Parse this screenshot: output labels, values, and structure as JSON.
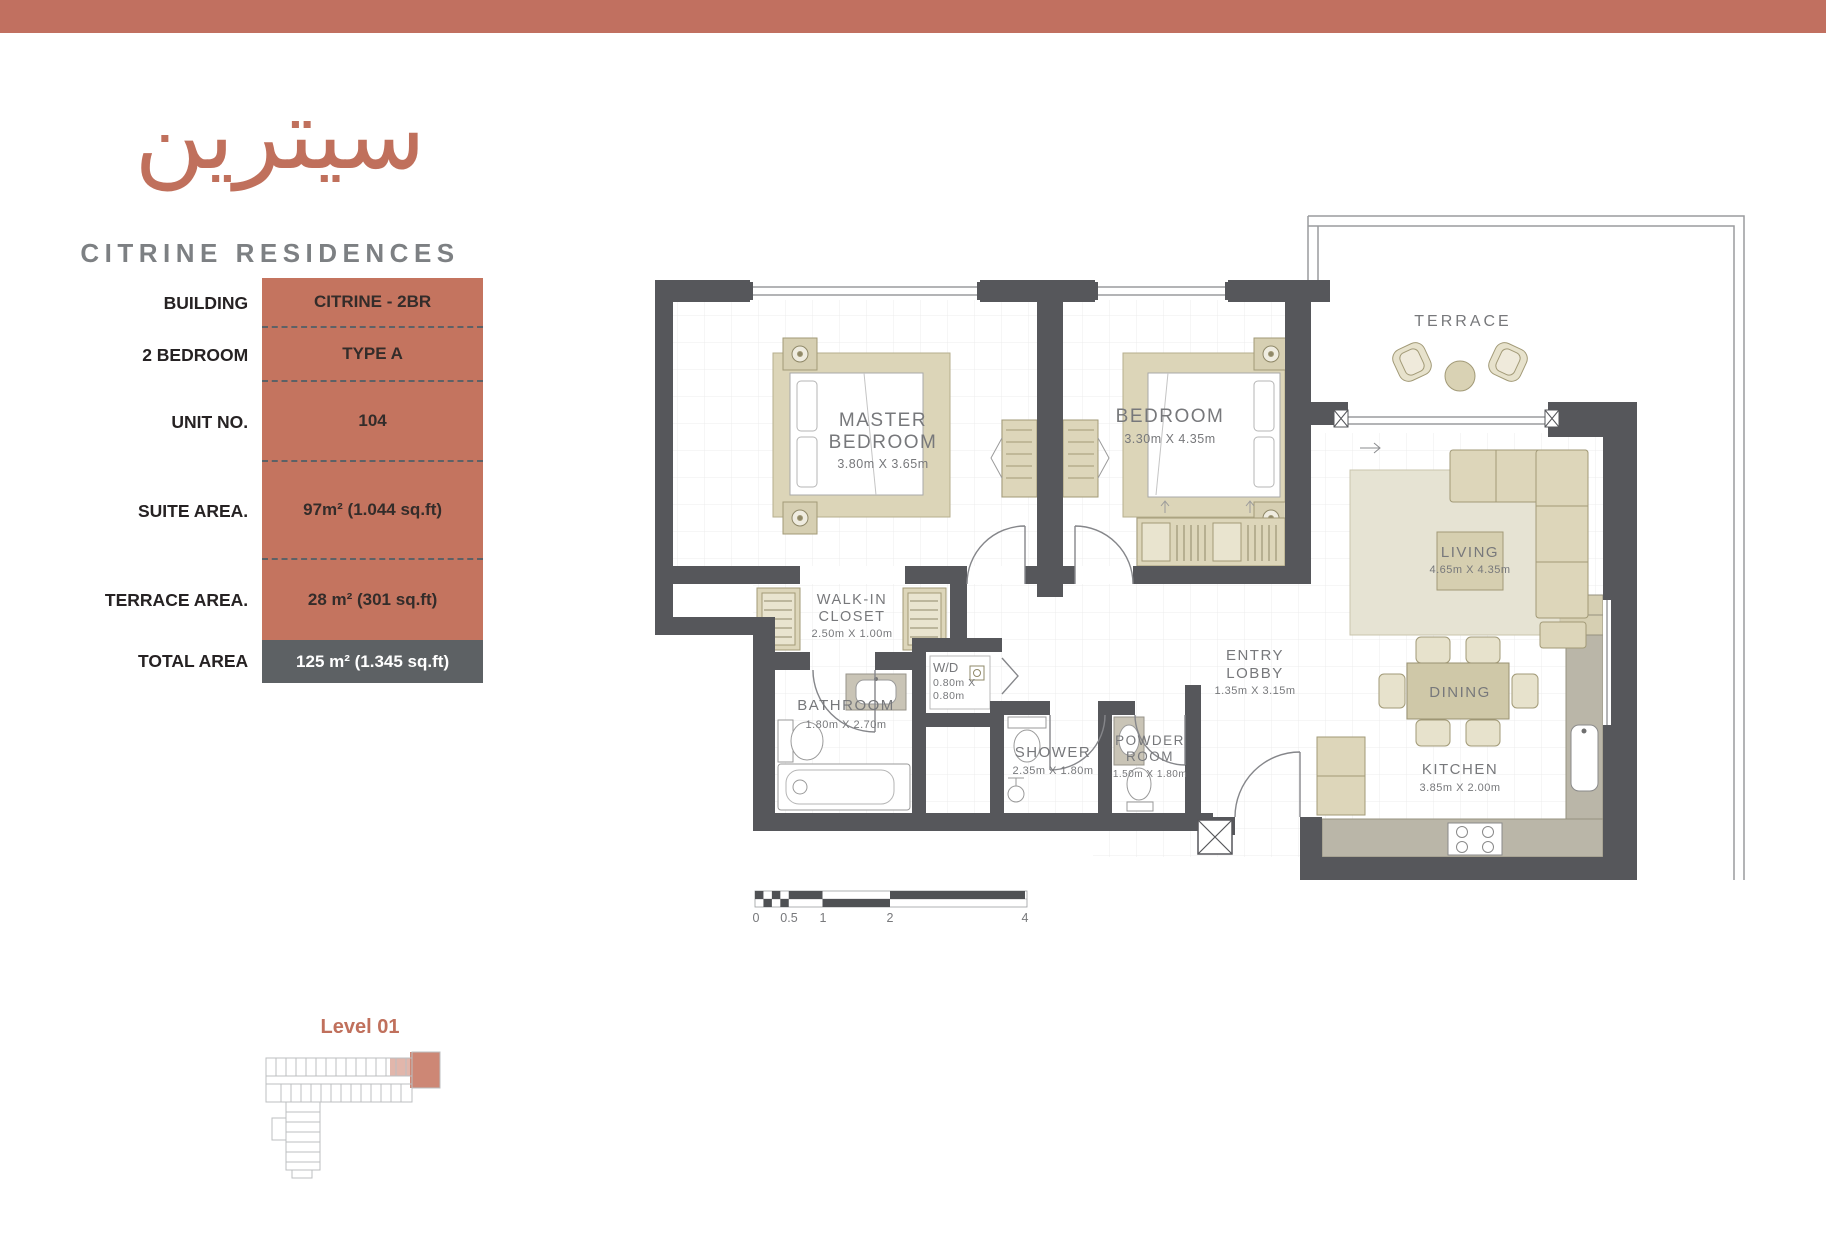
{
  "brand": {
    "logo_arabic": "سيترين",
    "name": "CITRINE RESIDENCES"
  },
  "unit_info": {
    "rows": [
      {
        "label": "BUILDING",
        "value": "CITRINE - 2BR"
      },
      {
        "label": "2 BEDROOM",
        "value": "TYPE A"
      },
      {
        "label": "UNIT NO.",
        "value": "104"
      },
      {
        "label": "SUITE AREA.",
        "value": "97m² (1.044 sq.ft)"
      },
      {
        "label": "TERRACE AREA.",
        "value": "28 m² (301 sq.ft)"
      },
      {
        "label": "TOTAL AREA",
        "value": "125 m² (1.345 sq.ft)"
      }
    ]
  },
  "floor_plan": {
    "rooms": [
      {
        "lines": [
          "MASTER",
          "BEDROOM"
        ],
        "dims": [
          "3.80m X 3.65m"
        ]
      },
      {
        "lines": [
          "BEDROOM"
        ],
        "dims": [
          "3.30m X 4.35m"
        ]
      },
      {
        "lines": [
          "WALK-IN",
          "CLOSET"
        ],
        "dims": [
          "2.50m X 1.00m"
        ]
      },
      {
        "lines": [
          "W/D"
        ],
        "dims": [
          "0.80m X",
          "0.80m"
        ]
      },
      {
        "lines": [
          "BATHROOM"
        ],
        "dims": [
          "1.80m X 2.70m"
        ]
      },
      {
        "lines": [
          "SHOWER"
        ],
        "dims": [
          "2.35m X 1.80m"
        ]
      },
      {
        "lines": [
          "POWDER",
          "ROOM"
        ],
        "dims": [
          "1.50m X 1.80m"
        ]
      },
      {
        "lines": [
          "ENTRY",
          "LOBBY"
        ],
        "dims": [
          "1.35m X 3.15m"
        ]
      },
      {
        "lines": [
          "LIVING"
        ],
        "dims": [
          "4.65m X 4.35m"
        ]
      },
      {
        "lines": [
          "DINING"
        ],
        "dims": []
      },
      {
        "lines": [
          "KITCHEN"
        ],
        "dims": [
          "3.85m X 2.00m"
        ]
      },
      {
        "lines": [
          "TERRACE"
        ],
        "dims": []
      }
    ],
    "scale_bar": {
      "labels": [
        "0",
        "0.5",
        "1",
        "2",
        "4"
      ]
    }
  },
  "key_plan": {
    "level_label": "Level 01"
  },
  "colors": {
    "accent": "#c0705c",
    "header_bar": "#c17060",
    "table_value_bg": "#c4745f",
    "total_row_bg": "#5d6164",
    "wall": "#56575b",
    "furniture_tan": "#ddd6ba",
    "label_gray": "#77787b"
  }
}
